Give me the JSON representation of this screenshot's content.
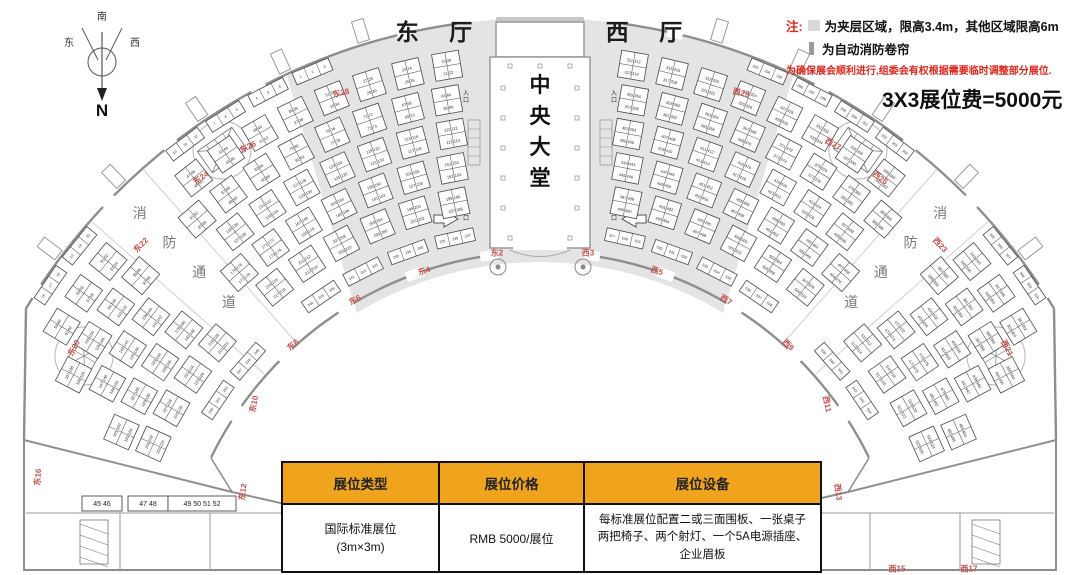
{
  "halls": {
    "east": "东 厅",
    "west": "西 厅",
    "central": "中\n央\n大\n堂"
  },
  "compass": {
    "north": "N",
    "south": "南",
    "east": "东",
    "west": "西"
  },
  "notes": {
    "prefix": "注:",
    "mezzanine": "为夹层区域，限高3.4m，其他区域限高6m",
    "shutter": "为自动消防卷帘",
    "warning": "为确保展会顺利进行,组委会有权根据需要临时调整部分展位.",
    "fee": "3X3展位费=5000元"
  },
  "fire_lane_label": "消防通道",
  "entrance_label": "入口",
  "table": {
    "headers": [
      "展位类型",
      "展位价格",
      "展位设备"
    ],
    "row": {
      "type_line1": "国际标准展位",
      "type_line2": "(3m×3m)",
      "price": "RMB 5000/展位",
      "equipment": "每标准展位配置二或三面围板、一张桌子两把椅子、两个射灯、一个5A电源插座、企业眉板"
    }
  },
  "gates": [
    {
      "label": "东2",
      "x": 497,
      "y": 253,
      "rot": 0
    },
    {
      "label": "东4",
      "x": 424,
      "y": 271,
      "rot": -18
    },
    {
      "label": "东6",
      "x": 355,
      "y": 300,
      "rot": -30
    },
    {
      "label": "东8",
      "x": 293,
      "y": 345,
      "rot": -42
    },
    {
      "label": "东10",
      "x": 254,
      "y": 404,
      "rot": -78
    },
    {
      "label": "东12",
      "x": 243,
      "y": 492,
      "rot": -82
    },
    {
      "label": "东16",
      "x": 38,
      "y": 477,
      "rot": -86
    },
    {
      "label": "东20",
      "x": 74,
      "y": 348,
      "rot": -62
    },
    {
      "label": "东22",
      "x": 141,
      "y": 245,
      "rot": -46
    },
    {
      "label": "东24",
      "x": 201,
      "y": 178,
      "rot": -36
    },
    {
      "label": "东26",
      "x": 248,
      "y": 147,
      "rot": -28
    },
    {
      "label": "东28",
      "x": 341,
      "y": 93,
      "rot": -13
    },
    {
      "label": "西3",
      "x": 588,
      "y": 253,
      "rot": 0
    },
    {
      "label": "西5",
      "x": 657,
      "y": 271,
      "rot": 18
    },
    {
      "label": "西7",
      "x": 726,
      "y": 300,
      "rot": 30
    },
    {
      "label": "西9",
      "x": 788,
      "y": 345,
      "rot": 42
    },
    {
      "label": "西11",
      "x": 827,
      "y": 404,
      "rot": 78
    },
    {
      "label": "西13",
      "x": 838,
      "y": 492,
      "rot": 82
    },
    {
      "label": "西15",
      "x": 897,
      "y": 569,
      "rot": 0
    },
    {
      "label": "西17",
      "x": 969,
      "y": 569,
      "rot": 0
    },
    {
      "label": "西21",
      "x": 1007,
      "y": 348,
      "rot": 62
    },
    {
      "label": "西23",
      "x": 940,
      "y": 245,
      "rot": 46
    },
    {
      "label": "西25",
      "x": 880,
      "y": 178,
      "rot": 36
    },
    {
      "label": "西27",
      "x": 833,
      "y": 144,
      "rot": 28
    },
    {
      "label": "西29",
      "x": 741,
      "y": 93,
      "rot": 13
    }
  ],
  "bottom_left_booths": [
    "45 46",
    "47 48",
    "49 50 51 52"
  ],
  "sample_booth_numbers": [
    "1 2 3 4 5 6 7 8",
    "9 10 11 12 13 14 15 16",
    "17 18 19 20",
    "77 78 79",
    "80 81 82",
    "83 84 85 86",
    "91 92 / 140 141",
    "95 94 / 138 139",
    "97 96 / 136 137",
    "99 98 / 134 135",
    "151 150",
    "153 152 / 198 199",
    "205 206 / 246 247",
    "207 208 / 262 263",
    "253 254 / 287 288",
    "264 265",
    "53 54 55 56",
    "61 62 63 64",
    "68 69 70 71",
    "293 294 295 296 297 298 299 300 301 302",
    "303 304 305 306 307 308",
    "372 371 370",
    "373 374 375 376 377",
    "179 180",
    "380 381 382 / 432 433 434",
    "383 384 / 438 439",
    "440 441 442 / 491 492 493",
    "443 444 / 489 490",
    "494 495 496",
    "497 498 / 536 537",
    "499 500 / 538 539",
    "542 543 / 585 586",
    "545 546 / 581 582"
  ],
  "booth_field": {
    "center": {
      "x": 540,
      "y": 618
    },
    "east_start_number": 1,
    "west_start_number": 293,
    "aisle_px": 13,
    "fire_lane_a": 45,
    "fire_lane_half_width": 3.6,
    "rings": [
      {
        "r": 592,
        "type": "single",
        "depth": 13,
        "min_a": 6,
        "max_a": 60
      },
      {
        "r": 560,
        "type": "quad",
        "size": 27,
        "min_a": 7.5,
        "max_a": 62
      },
      {
        "r": 526,
        "type": "quad",
        "size": 27,
        "min_a": 8,
        "max_a": 64
      },
      {
        "r": 492,
        "type": "quad",
        "size": 27,
        "min_a": 8,
        "max_a": 66
      },
      {
        "r": 458,
        "type": "quad",
        "size": 27,
        "min_a": 8.5,
        "max_a": 67
      },
      {
        "r": 424,
        "type": "quad",
        "size": 27,
        "min_a": 9,
        "max_a": 67
      },
      {
        "r": 389,
        "type": "single",
        "depth": 13,
        "min_a": 9,
        "max_a": 63
      }
    ]
  },
  "colors": {
    "header_yellow": "#F0A41E",
    "note_red": "#E0261C",
    "gate_red": "#C4504E",
    "wall": "#8E8E8E",
    "mezzanine": "#E4E4E4",
    "booth_stroke": "#4a4a4a"
  }
}
